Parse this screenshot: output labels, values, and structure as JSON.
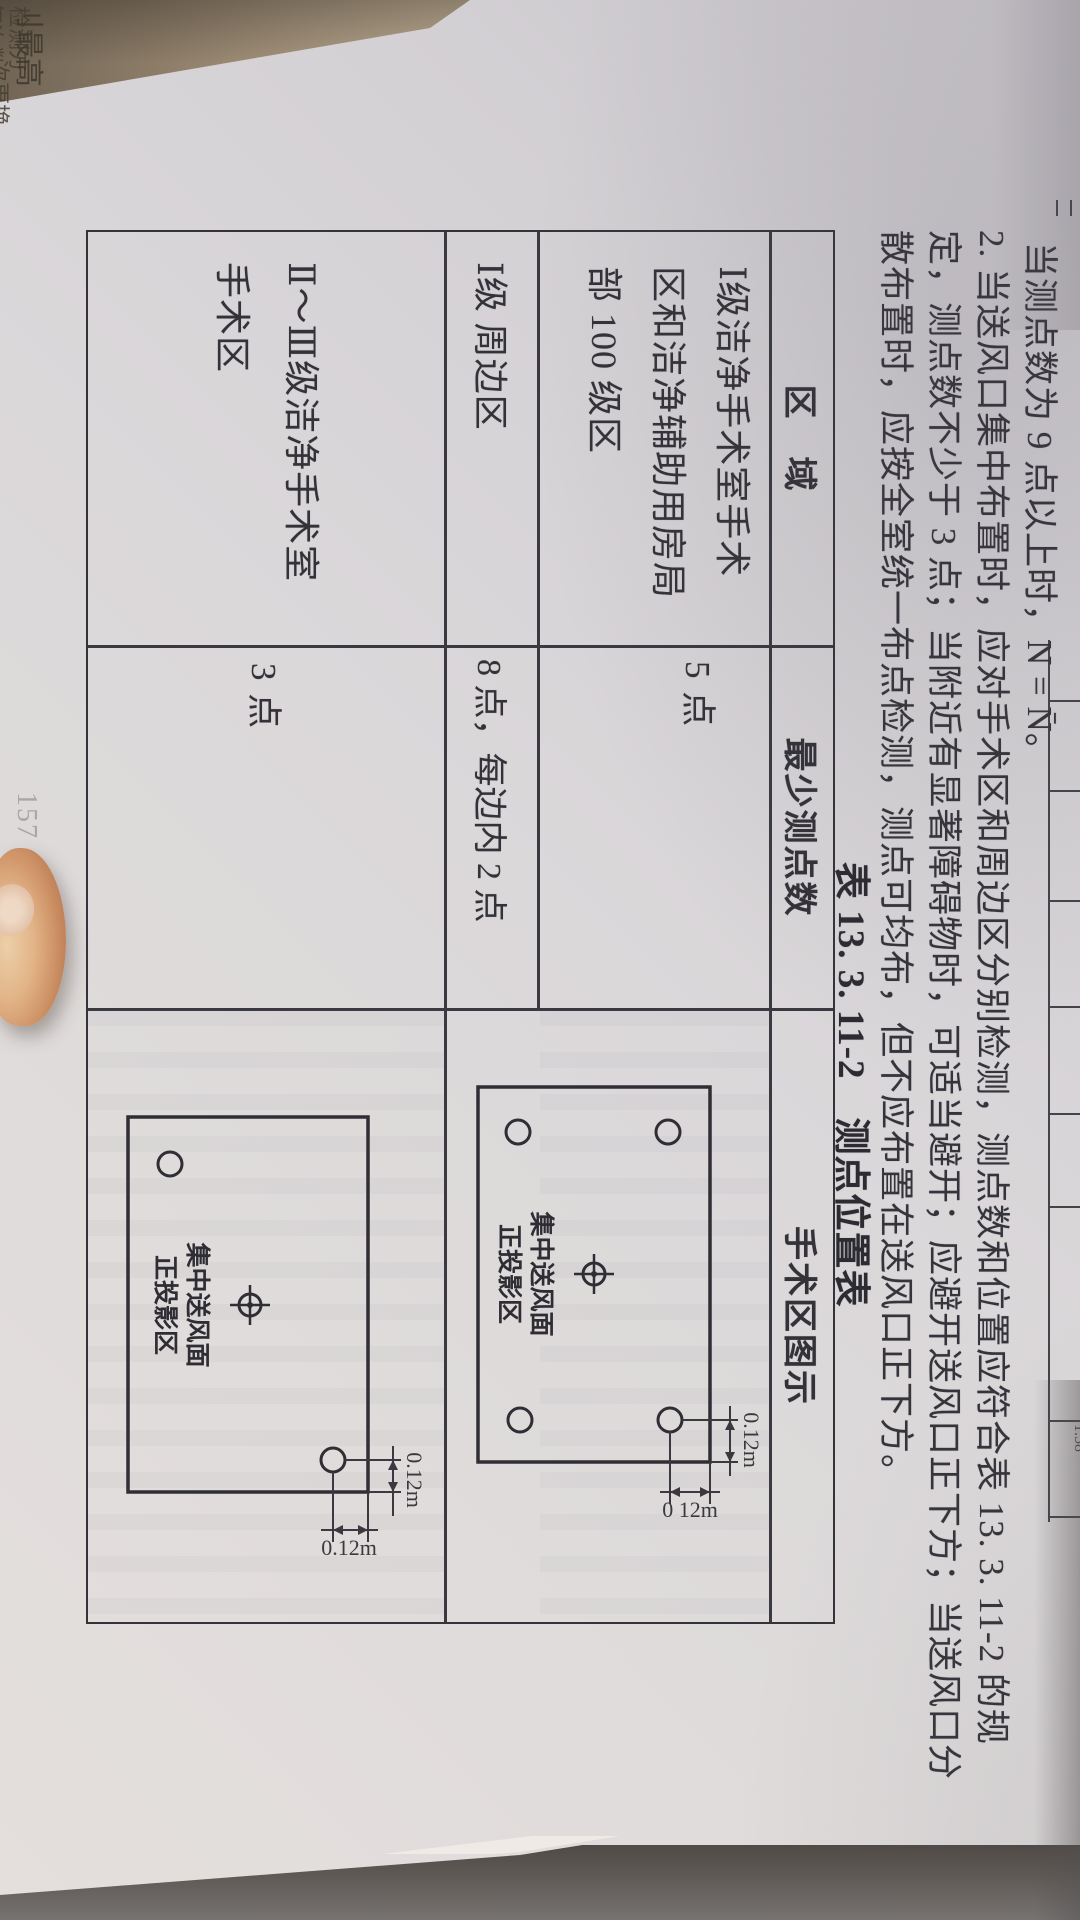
{
  "edge_fragments": {
    "f1": "气次数，",
    "f2": "检测方",
    "f3": "次更换",
    "f4": "刂最高"
  },
  "prev_table": {
    "digits": "1.58"
  },
  "notes": {
    "line1": "当测点数为 9 点以上时，N = N̄。",
    "line2": "2. 当送风口集中布置时，应对手术区和周边区分别检测，测点数和位置应符合表 13. 3. 11-2 的规",
    "line3": "定，测点数不少于 3 点；当附近有显著障碍物时，可适当避开；应避开送风口正下方；当送风口分",
    "line4": "散布置时，应按全室统一布点检测，测点可均布，但不应布置在送风口正下方。"
  },
  "caption": "表 13. 3. 11-2　测点位置表",
  "table": {
    "header": {
      "region": "区　域",
      "min_points": "最少测点数",
      "diagram": "手术区图示"
    },
    "rows": [
      {
        "region": "Ⅰ级洁净手术室手术区和洁净辅助用房局部 100 级区",
        "points": "5 点"
      },
      {
        "region": "Ⅰ级 周边区",
        "points": "8 点，每边内 2 点"
      },
      {
        "region": "Ⅱ～Ⅲ级洁净手术室手术区",
        "points": "3 点"
      }
    ]
  },
  "diagram_1": {
    "label1": "集中送风面",
    "label2": "正投影区",
    "dim_top": "0.12m",
    "dim_right": "0 12m"
  },
  "diagram_2": {
    "label1": "集中送风面",
    "label2": "正投影区",
    "dim_top": "0.12m",
    "dim_right": "0.12m"
  },
  "page_number": "157"
}
